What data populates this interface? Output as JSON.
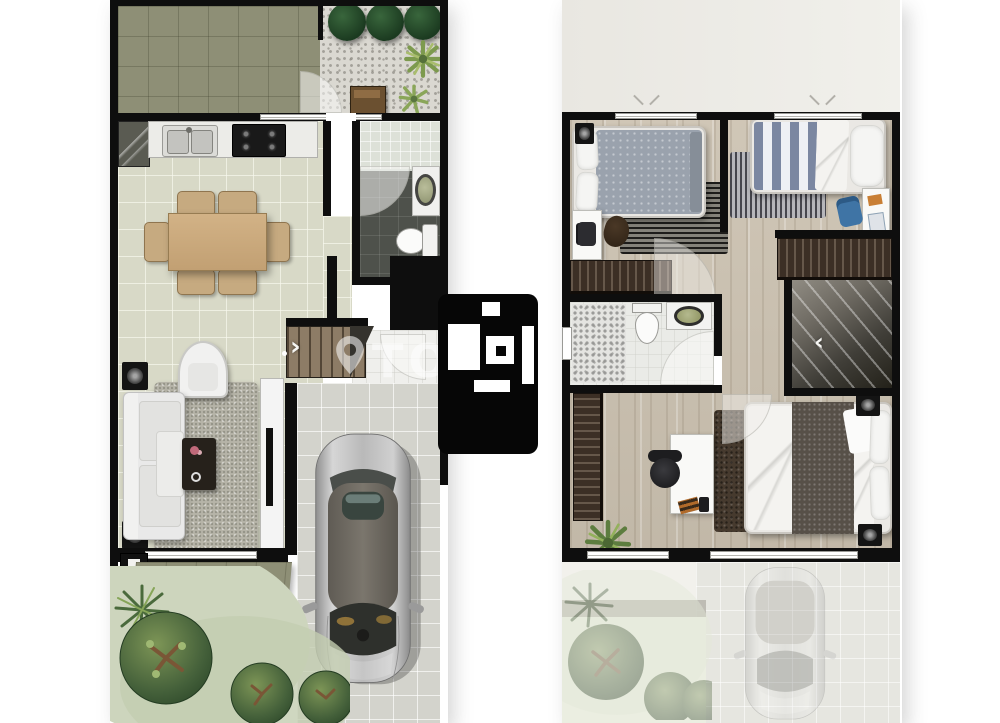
{
  "watermark": {
    "letters": "TO",
    "pin_icon": "map-pin-icon",
    "logo_icon": "app-logo"
  },
  "plans": {
    "ground": {
      "name": "ground-floor-plan",
      "stairs_arrow": "›",
      "rooms": [
        "backyard-patio",
        "pebble-courtyard",
        "kitchen",
        "dining-area",
        "powder-room",
        "entry-hall",
        "living-room",
        "staircase",
        "garage-driveway",
        "front-porch",
        "front-garden"
      ],
      "furniture": [
        "round-trees",
        "palm-plants",
        "garden-bench",
        "kitchen-cabinet",
        "double-sink",
        "cooktop",
        "dining-table",
        "dining-chairs",
        "shower",
        "washbasin",
        "toilet",
        "sofa",
        "armchair",
        "coffee-table",
        "area-rug",
        "tv-console",
        "speakers",
        "car"
      ]
    },
    "upper": {
      "name": "second-floor-plan",
      "stairs_arrow": "‹",
      "rooms": [
        "roof-terrace",
        "bedroom-2",
        "bedroom-3",
        "bathroom",
        "hallway",
        "stairwell",
        "master-bedroom",
        "carport-below"
      ],
      "furniture": [
        "single-bed-gray",
        "single-bed-striped",
        "double-bed",
        "desks",
        "desk-chairs",
        "wardrobes",
        "striped-rugs",
        "shower",
        "washbasin",
        "toilet",
        "speakers",
        "potted-plant",
        "faded-car"
      ]
    }
  },
  "palette": {
    "wall": "#0e0e0e",
    "patio_tile": "#8e8f76",
    "interior_tile": "#d8d9c7",
    "dark_tile": "#4e514b",
    "wood_floor": "#ccc2b1",
    "paver": "#d3d3cc",
    "tree": "#1b3a20",
    "bush": "#44603a",
    "wardrobe": "#3c2f25",
    "stair_tread": "#8d7c66",
    "duvet_gray": "#9aa2ad",
    "duvet_stripe_blue": "#7b87a1",
    "car_body": "#b9b9b9",
    "watermark_white": "#ffffff"
  }
}
